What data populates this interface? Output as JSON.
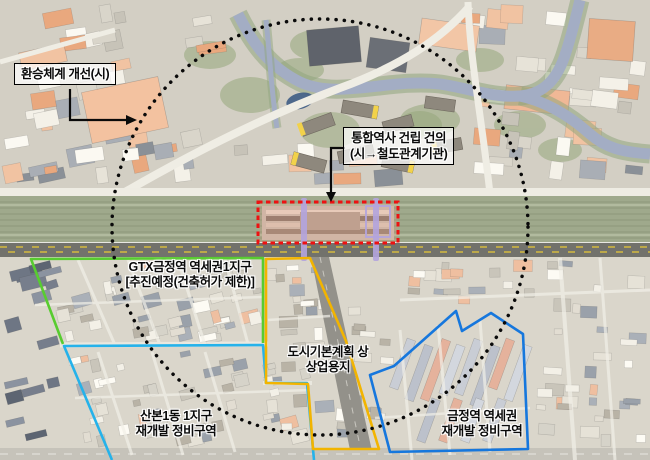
{
  "annotations": {
    "transfer_box": {
      "text": "환승체계 개선(시)"
    },
    "station_box": {
      "line1": "통합역사 건립 건의",
      "line2": "(시→철도관계기관)"
    },
    "gtx_zone": {
      "line1": "GTX금정역 역세권1지구",
      "line2": "[추진예정(건축허가 제한)]"
    },
    "commercial_zone": {
      "line1": "도시기본계획 상",
      "line2": "상업용지"
    },
    "sanbon_zone": {
      "line1": "산본1동 1지구",
      "line2": "재개발 정비구역"
    },
    "geumjeong_zone": {
      "line1": "금정역 역세권",
      "line2": "재개발 정비구역"
    }
  },
  "colors": {
    "gtx_zone_boundary": "#58cc30",
    "commercial_zone_boundary": "#f2b400",
    "sanbon_zone_boundary": "#25b2ea",
    "geumjeong_zone_boundary": "#1677dd",
    "station_highlight_box": "#ee1111",
    "study_area_circle": "#0a0a0a",
    "annotation_arrow": "#0a0a0a"
  }
}
